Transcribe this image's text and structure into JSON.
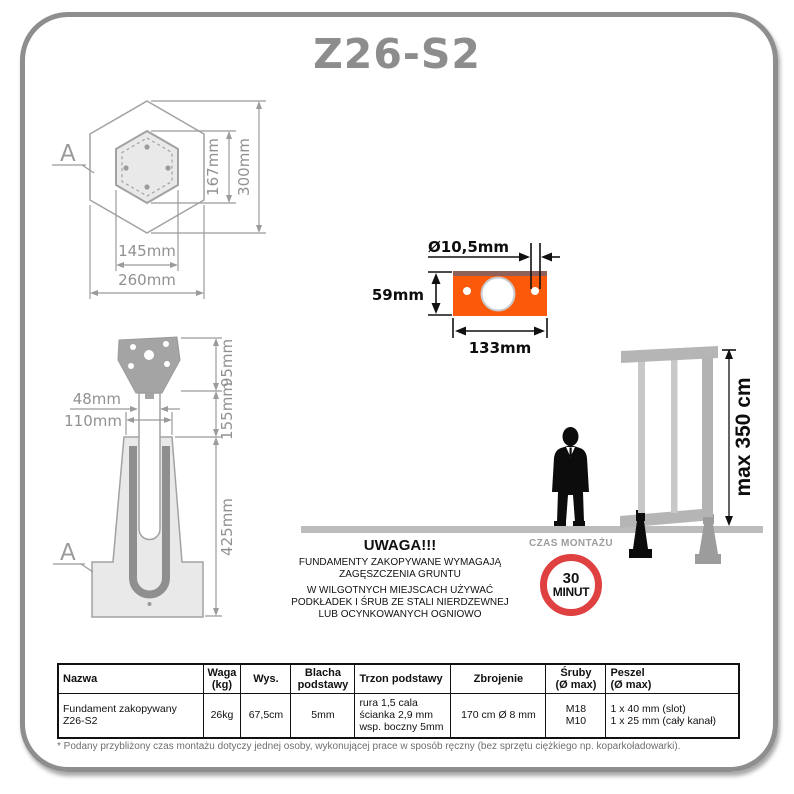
{
  "title": "Z26-S2",
  "colors": {
    "accent_orange": "#fa5a0a",
    "plate_top_edge": "#8e6058",
    "sign_red": "#df4040",
    "dim_gray": "#9b9b9b"
  },
  "hex_section": {
    "label": "A",
    "inner_height": "167mm",
    "outer_height": "300mm",
    "inner_width": "145mm",
    "outer_width": "260mm"
  },
  "side_section": {
    "label": "A",
    "head_height": "95mm",
    "above_ground": "155mm",
    "depth": "425mm",
    "tube_width": "48mm",
    "sleeve_width": "110mm"
  },
  "base_plate": {
    "hole_diameter": "Ø10,5mm",
    "height": "59mm",
    "width": "133mm"
  },
  "scene": {
    "max_height": "max 350 cm"
  },
  "warning": {
    "title": "UWAGA!!!",
    "lines": [
      "FUNDAMENTY ZAKOPYWANE WYMAGAJĄ",
      "ZAGĘSZCZENIA GRUNTU",
      "W WILGOTNYCH MIEJSCACH UŻYWAĆ",
      "PODKŁADEK I ŚRUB ZE STALI NIERDZEWNEJ",
      "LUB OCYNKOWANYCH OGNIOWO"
    ]
  },
  "assembly_time": {
    "label": "CZAS MONTAŻU",
    "value": "30",
    "unit": "MINUT"
  },
  "table": {
    "headers": {
      "nazwa": [
        "Nazwa"
      ],
      "waga": [
        "Waga",
        "(kg)"
      ],
      "wys": [
        "Wys."
      ],
      "blacha": [
        "Blacha",
        "podstawy"
      ],
      "trzon": [
        "Trzon podstawy"
      ],
      "zbrojenie": [
        "Zbrojenie"
      ],
      "sruby": [
        "Śruby",
        "(Ø max)"
      ],
      "peszel": [
        "Peszel",
        "(Ø max)"
      ]
    },
    "row": {
      "nazwa": [
        "Fundament zakopywany",
        "Z26-S2"
      ],
      "waga": "26kg",
      "wys": "67,5cm",
      "blacha": "5mm",
      "trzon": [
        "rura 1,5 cala",
        "ścianka 2,9 mm",
        "wsp. boczny 5mm"
      ],
      "zbrojenie": "170 cm Ø 8 mm",
      "sruby": [
        "M18",
        "M10"
      ],
      "peszel": [
        "1 x 40 mm (slot)",
        "1 x 25 mm (cały kanał)"
      ]
    }
  },
  "footnote": "* Podany przybliżony czas montażu dotyczy jednej osoby, wykonującej prace w sposób ręczny (bez sprzętu ciężkiego np. koparkoładowarki)."
}
